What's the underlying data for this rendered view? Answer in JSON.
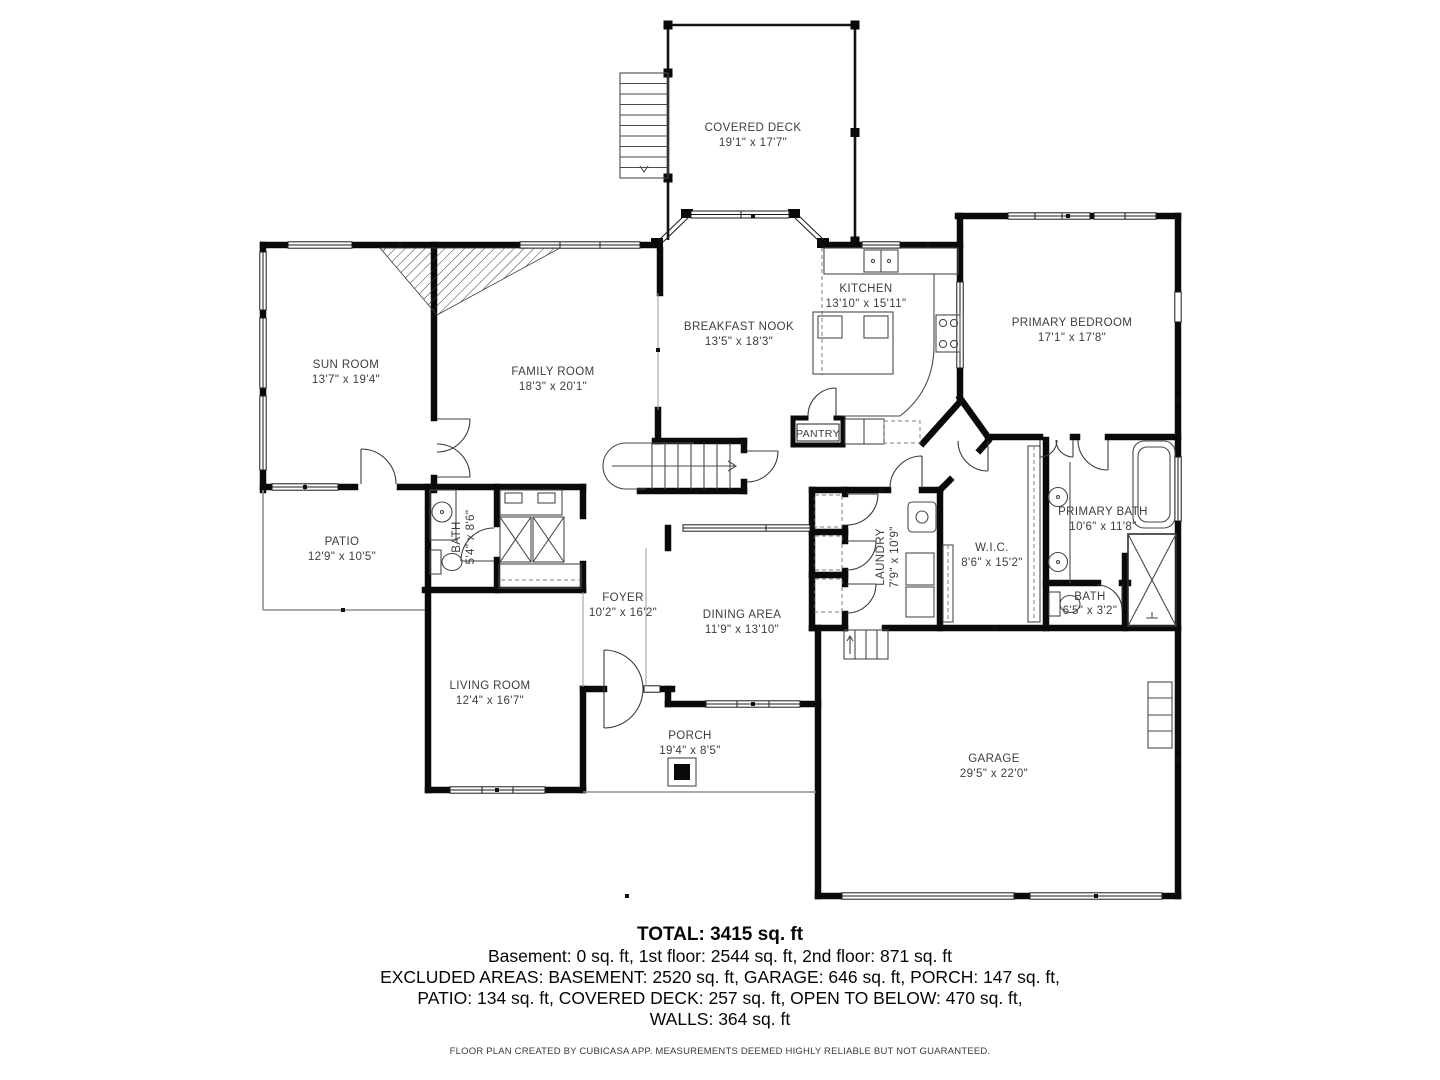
{
  "floorplan": {
    "rooms": [
      {
        "name": "COVERED DECK",
        "dims": "19'1\" x 17'7\""
      },
      {
        "name": "KITCHEN",
        "dims": "13'10\" x 15'11\""
      },
      {
        "name": "BREAKFAST NOOK",
        "dims": "13'5\" x 18'3\""
      },
      {
        "name": "PRIMARY BEDROOM",
        "dims": "17'1\" x 17'8\""
      },
      {
        "name": "SUN ROOM",
        "dims": "13'7\" x 19'4\""
      },
      {
        "name": "FAMILY ROOM",
        "dims": "18'3\" x 20'1\""
      },
      {
        "name": "PANTRY",
        "dims": ""
      },
      {
        "name": "PRIMARY BATH",
        "dims": "10'6\" x 11'8\""
      },
      {
        "name": "PATIO",
        "dims": "12'9\" x 10'5\""
      },
      {
        "name": "BATH",
        "dims": "5'4\" x 8'6\""
      },
      {
        "name": "LAUNDRY",
        "dims": "7'9\" x 10'9\""
      },
      {
        "name": "W.I.C.",
        "dims": "8'6\" x 15'2\""
      },
      {
        "name": "BATH",
        "dims": "6'5\" x 3'2\""
      },
      {
        "name": "FOYER",
        "dims": "10'2\" x 16'2\""
      },
      {
        "name": "DINING AREA",
        "dims": "11'9\" x 13'10\""
      },
      {
        "name": "LIVING ROOM",
        "dims": "12'4\" x 16'7\""
      },
      {
        "name": "PORCH",
        "dims": "19'4\" x 8'5\""
      },
      {
        "name": "GARAGE",
        "dims": "29'5\" x 22'0\""
      }
    ],
    "summary": {
      "total": "TOTAL: 3415 sq. ft",
      "floors": "Basement: 0 sq. ft, 1st floor: 2544 sq. ft, 2nd floor: 871 sq. ft",
      "excluded1": "EXCLUDED AREAS: BASEMENT: 2520 sq. ft, GARAGE: 646 sq. ft, PORCH: 147 sq. ft,",
      "excluded2": "PATIO: 134 sq. ft, COVERED DECK: 257 sq. ft, OPEN TO BELOW: 470 sq. ft,",
      "excluded3": "WALLS: 364 sq. ft"
    },
    "footer": "FLOOR PLAN CREATED BY CUBICASA APP. MEASUREMENTS DEEMED HIGHLY RELIABLE BUT NOT GUARANTEED.",
    "colors": {
      "wall": "#0a0a0a",
      "label": "#3d3d3d",
      "background": "#ffffff"
    }
  }
}
